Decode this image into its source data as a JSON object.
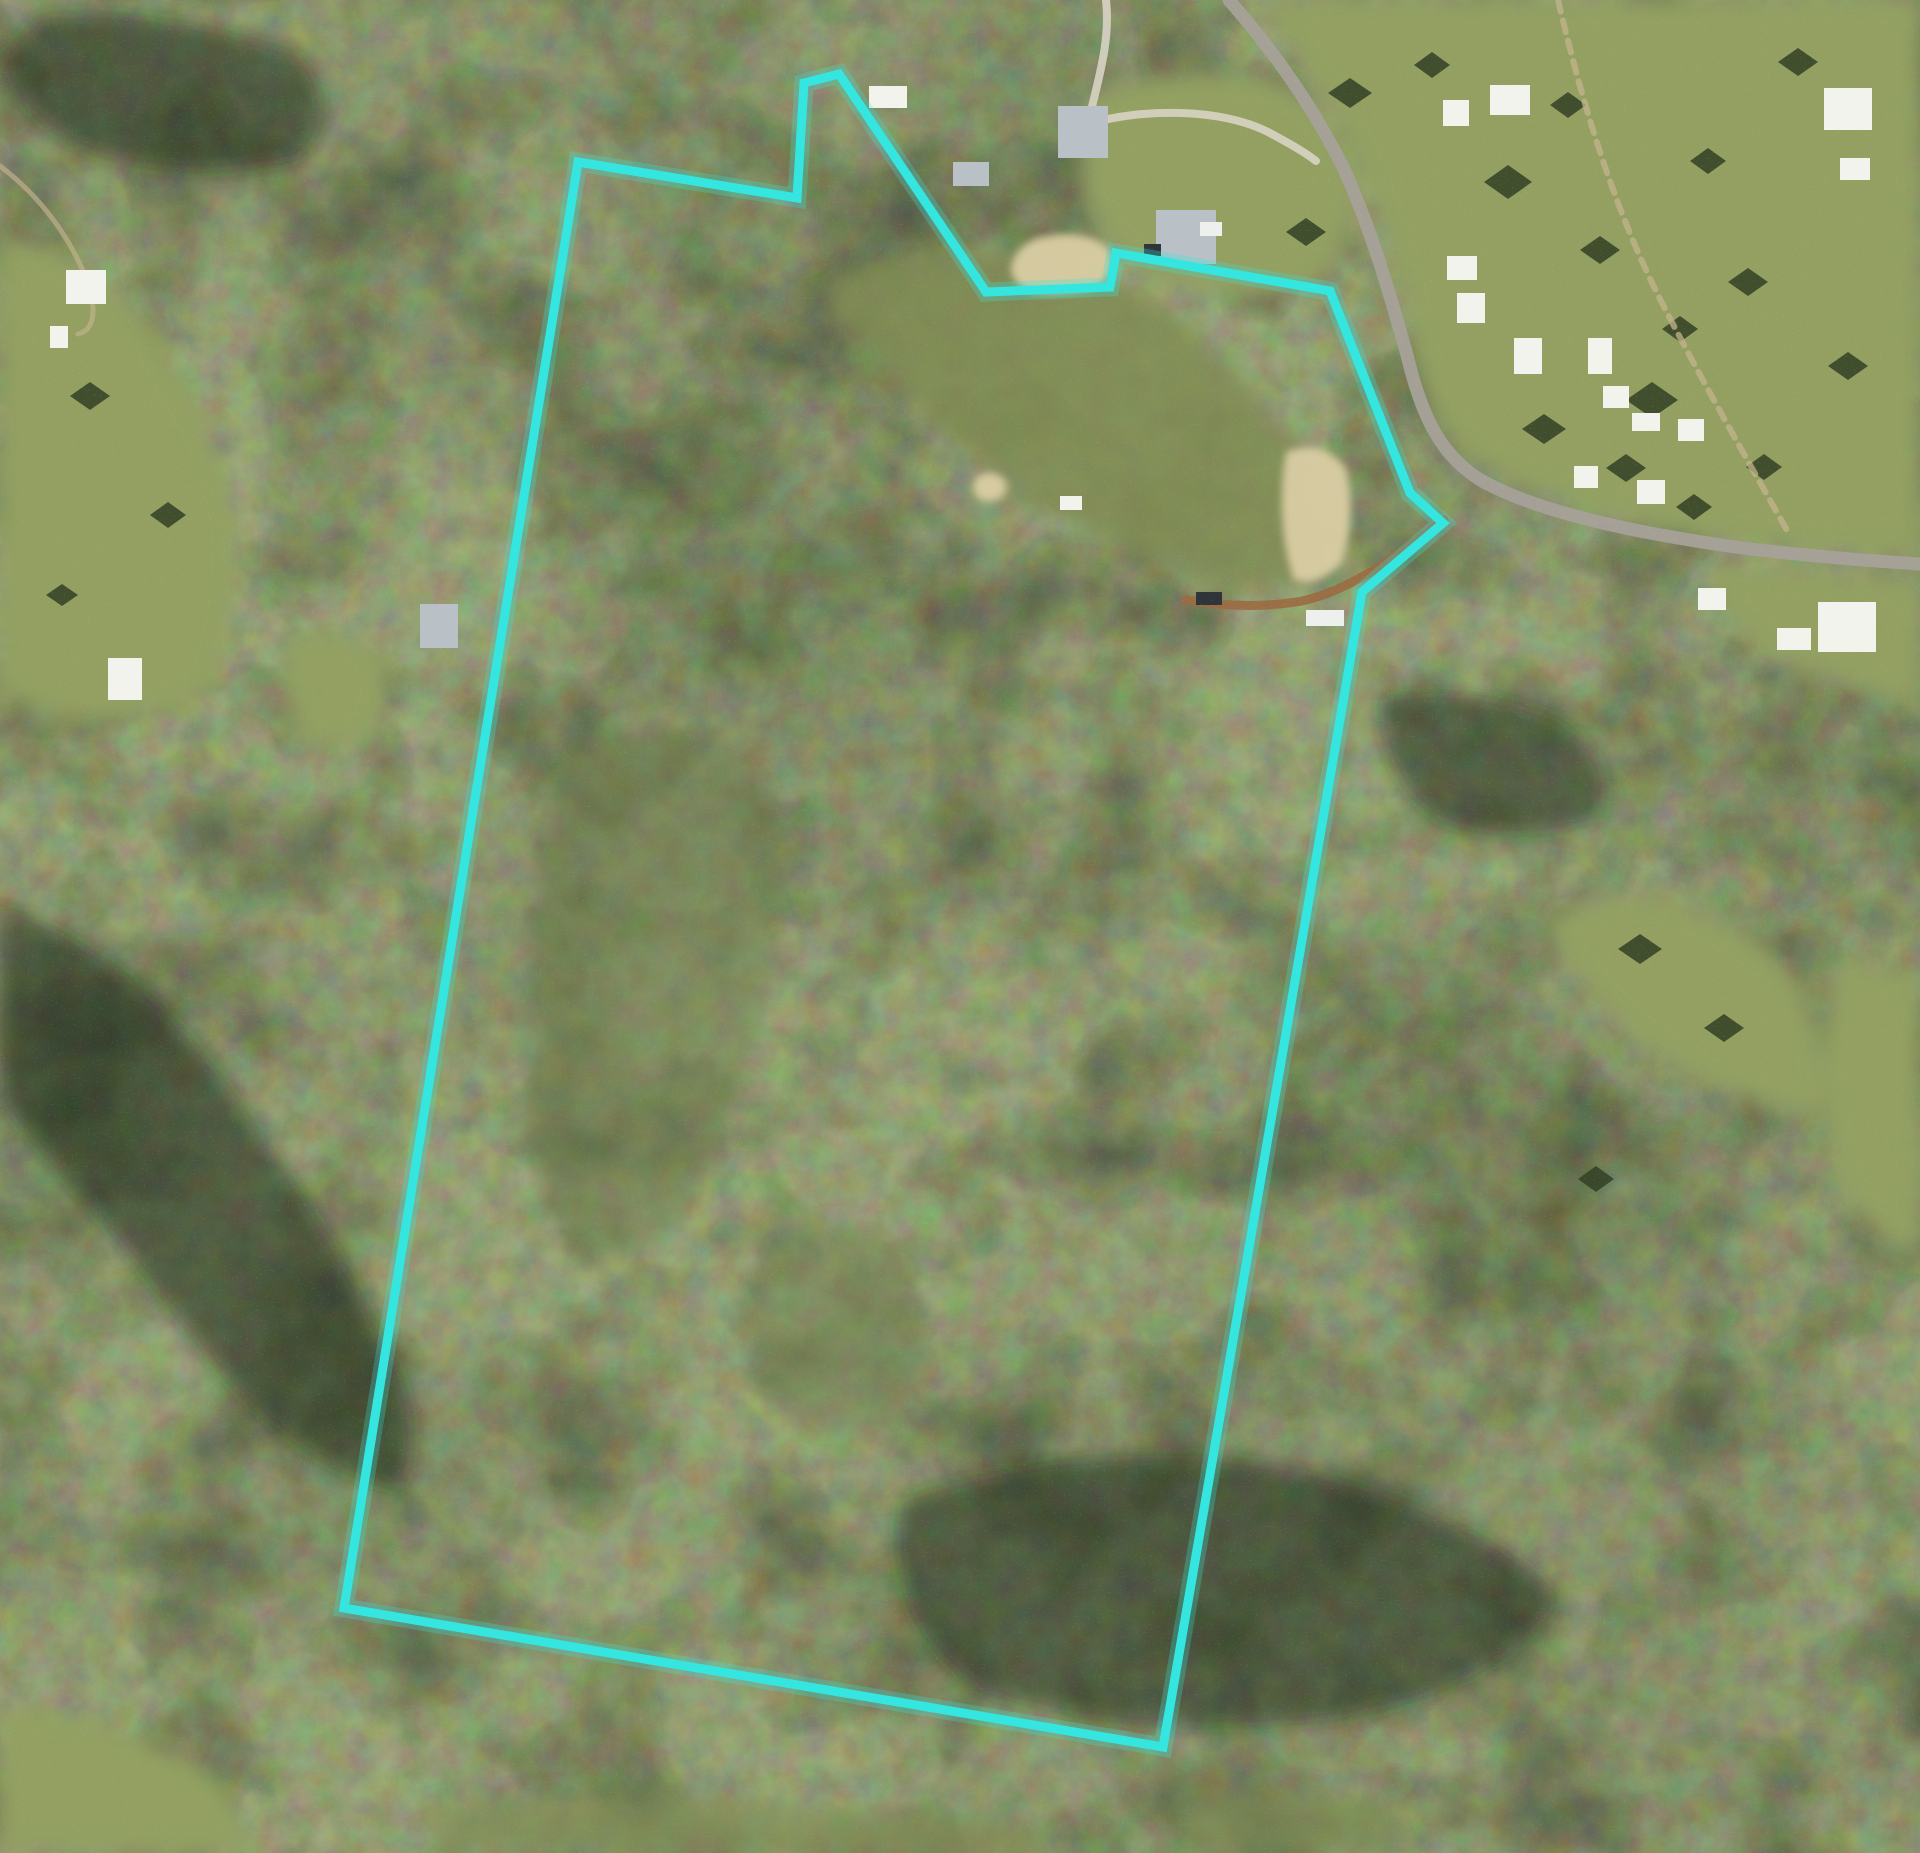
{
  "image": {
    "width": 1920,
    "height": 1853,
    "alt": "Aerial photograph of a forested rural property outlined with a cyan boundary line, with a road, village houses and pasture clearings in the top right"
  },
  "colors": {
    "boundary_cyan": "#35e6e0",
    "forest_base": "#4a5539",
    "pasture_green": "#93a062",
    "sand_tan": "#d9cca3",
    "road_grey": "#a6a199",
    "dirt_brown": "#9b6a41"
  },
  "boundary": {
    "color": "#35e6e0",
    "points": "578,162 797,198 804,83 839,74 986,292 1110,287 1116,253 1330,291 1410,493 1443,523 1362,592 1163,1747 344,1608"
  },
  "terrain": {
    "pastures": "M1240,0 L1920,0 L1920,558 Q1800,550 1700,535 Q1580,512 1490,468 Q1440,440 1422,385 Q1408,300 1380,220 Q1350,130 1295,55 Q1271,22 1252,0 Z M1705,565 L1920,580 L1920,705 Q1830,680 1770,655 Q1722,620 1705,565 Z M1545,925 Q1600,880 1680,905 Q1760,930 1800,990 Q1830,1058 1820,1115 Q1740,1105 1665,1060 Q1590,1008 1545,925 Z M1835,960 L1920,975 L1920,1255 Q1866,1234 1838,1180 Q1812,1080 1835,960 Z M0,235 Q90,250 150,330 Q215,425 235,520 Q240,620 210,690 Q140,730 60,715 L0,695 Z M292,636 Q350,628 382,652 Q395,700 368,738 Q322,758 296,732 Q282,680 292,636 Z M0,1705 Q100,1715 190,1762 Q242,1792 252,1853 L0,1853 Z M1086,95 Q1180,68 1262,78 Q1330,95 1352,170 Q1360,240 1318,282 Q1240,305 1160,282 Q1098,250 1082,180 Q1078,130 1086,95 Z",
    "scrub": "M822,285 Q900,248 1000,252 Q1090,258 1160,305 Q1240,365 1300,452 Q1335,520 1332,570 Q1270,600 1180,572 Q1080,535 990,470 Q905,405 860,345 Q835,310 822,285 Z",
    "ridge": "M560,760 Q640,700 722,740 Q792,800 782,920 Q762,1060 702,1180 Q642,1280 572,1260 Q522,1180 522,1040 Q527,880 560,760 Z M760,1245 Q840,1205 900,1245 Q940,1305 912,1385 Q860,1445 790,1425 Q740,1375 745,1305 Z",
    "bottom_patches": "M430,1808 Q560,1790 700,1798 Q900,1812 1050,1825 L1050,1853 L430,1853 Z M1180,1798 Q1290,1782 1400,1802 L1400,1853 L1180,1853 Z",
    "shadows": "M0,905 Q120,950 200,1050 Q300,1180 380,1330 Q432,1430 400,1490 Q300,1470 210,1360 Q90,1200 0,1105 Z M900,1500 Q1100,1430 1300,1470 Q1480,1510 1560,1600 Q1500,1690 1330,1720 Q1120,1740 980,1690 Q880,1620 900,1500 Z M1380,700 Q1470,680 1560,720 Q1620,760 1600,820 Q1520,850 1440,820 Q1380,780 1380,700 Z M40,15 Q160,5 300,55 Q345,108 300,158 Q180,188 80,148 Q10,108 0,58 Z",
    "sand_clearings": "M1012,262 Q1020,240 1048,236 Q1086,230 1108,248 Q1119,268 1101,286 Q1060,298 1025,290 Q1007,277 1012,262 Z M1286,452 Q1321,438 1346,468 Q1357,518 1341,564 Q1315,589 1293,579 Q1275,518 1286,452 Z M977,477 Q990,468 1004,478 Q1011,491 999,499 Q983,505 975,495 Q971,484 977,477 Z",
    "tree_clumps": "M1350,78 l22,15 -22,15 -22,-15 z M1432,52 l18,13 -18,13 -18,-13 z M1508,165 l24,17 -24,17 -24,-17 z M1568,92 l18,13 -18,13 -18,-13 z M1306,218 l20,14 -20,14 -20,-14 z M1652,382 l26,18 -26,18 -26,-18 z M1748,268 l20,14 -20,14 -20,-14 z M1848,352 l20,14 -20,14 -20,-14 z M1708,148 l18,13 -18,13 -18,-13 z M1798,48 l20,14 -20,14 -20,-14 z M1544,414 l22,15 -22,15 -22,-15 z M1626,454 l20,14 -20,14 -20,-14 z M1694,494 l18,13 -18,13 -18,-13 z M1764,454 l18,13 -18,13 -18,-13 z M90,382 l20,14 -20,14 -20,-14 z M168,502 l18,13 -18,13 -18,-13 z M62,584 l16,11 -16,11 -16,-11 z M1640,934 l22,15 -22,15 -22,-15 z M1724,1014 l20,14 -20,14 -20,-14 z M1596,1166 l18,13 -18,13 -18,-13 z M1600,236 l20,14 -20,14 -20,-14 z M1680,316 l18,13 -18,13 -18,-13 z"
  },
  "roads": {
    "main_road": "M1229,0 C1262,38 1305,92 1342,165 C1372,230 1390,295 1407,355 C1422,418 1442,458 1484,482 C1545,515 1645,534 1735,547 C1805,556 1872,561 1920,564",
    "farm_track": "M1558,0 C1578,85 1608,195 1658,295 C1700,378 1752,468 1788,532",
    "driveway": "M1106,0 C1111,44 1096,86 1088,124 C1142,108 1220,108 1268,132 C1290,144 1305,152 1316,161",
    "left_track": "M0,166 C42,198 70,238 86,278 C98,312 94,330 78,334",
    "dirt_road": "M1444,520 C1402,553 1352,590 1302,601 C1262,608 1222,606 1186,600"
  },
  "buildings": {
    "white_roofs": "M1490,85 h40 v30 h-40 z M1443,100 h26 v26 h-26 z M1824,88 h48 v42 h-48 z M1840,158 h30 v22 h-30 z M1447,256 h30 v24 h-30 z M1457,293 h28 v30 h-28 z M1514,338 h28 v36 h-28 z M1588,338 h24 v36 h-24 z M1603,386 h26 v22 h-26 z M1632,413 h28 v18 h-28 z M1678,419 h26 v22 h-26 z M1574,466 h24 v22 h-24 z M1637,480 h28 v24 h-28 z M1698,588 h28 v22 h-28 z M1777,628 h34 v22 h-34 z M1818,602 h58 v50 h-58 z M66,270 h40 v34 h-40 z M50,326 h18 v22 h-18 z M108,658 h34 v42 h-34 z M1060,496 h22 v14 h-22 z M869,86 h38 v22 h-38 z",
    "grey_roofs": "M1058,106 h50 v52 h-50 z M1156,210 h60 v54 h-60 z M420,604 h38 v44 h-38 z M953,162 h36 v24 h-36 z",
    "dark_vehicles": "M1144,244 h17 v12 h-17 z M1196,592 h26 v13 h-26 z",
    "white_vehicles": "M1306,610 h38 v16 h-38 z M1200,222 h22 v14 h-22 z"
  }
}
